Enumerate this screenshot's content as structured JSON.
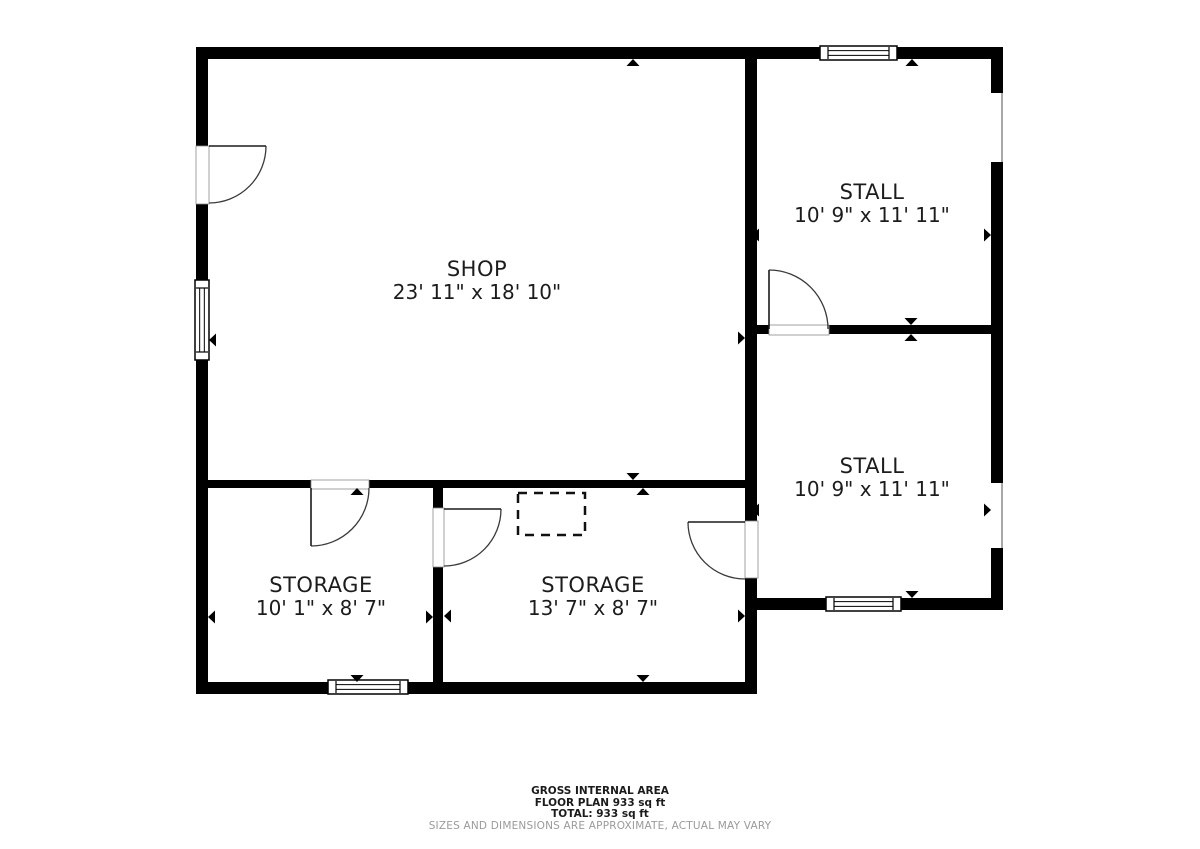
{
  "title": "Floor plan",
  "colors": {
    "wall": "#000000",
    "background": "#ffffff",
    "label_text": "#1c1c1c",
    "muted_text": "#9a9a9a",
    "door_line": "#3a3a3a",
    "opening_edge": "#8a8a8a"
  },
  "rooms": [
    {
      "id": "shop",
      "name": "SHOP",
      "dims": "23' 11\" x 18' 10\"",
      "cx": 477,
      "cy": 281
    },
    {
      "id": "stall-1",
      "name": "STALL",
      "dims": "10' 9\" x 11' 11\"",
      "cx": 872,
      "cy": 204
    },
    {
      "id": "stall-2",
      "name": "STALL",
      "dims": "10' 9\" x 11' 11\"",
      "cx": 872,
      "cy": 478
    },
    {
      "id": "storage-1",
      "name": "STORAGE",
      "dims": "10' 1\" x 8' 7\"",
      "cx": 321,
      "cy": 597
    },
    {
      "id": "storage-2",
      "name": "STORAGE",
      "dims": "13' 7\" x 8' 7\"",
      "cx": 593,
      "cy": 597
    }
  ],
  "footer": {
    "line1": "GROSS INTERNAL AREA",
    "line2": "FLOOR PLAN 933 sq ft",
    "line3": "TOTAL: 933 sq ft",
    "disclaimer": "SIZES AND DIMENSIONS ARE APPROXIMATE, ACTUAL MAY VARY"
  },
  "geometry": {
    "canvas": {
      "width": 1200,
      "height": 849
    },
    "walls": [
      {
        "name": "exterior-wall-top",
        "x": 196,
        "y": 47,
        "w": 807,
        "h": 12
      },
      {
        "name": "exterior-wall-left",
        "x": 196,
        "y": 47,
        "w": 12,
        "h": 647
      },
      {
        "name": "exterior-wall-right",
        "x": 991,
        "y": 47,
        "w": 12,
        "h": 563
      },
      {
        "name": "exterior-wall-bottom",
        "x": 196,
        "y": 682,
        "w": 561,
        "h": 12
      },
      {
        "name": "wall-center-vertical",
        "x": 745,
        "y": 47,
        "w": 12,
        "h": 647
      },
      {
        "name": "wall-shop-storage",
        "x": 208,
        "y": 480,
        "w": 537,
        "h": 8
      },
      {
        "name": "wall-stall-divider",
        "x": 757,
        "y": 325,
        "w": 234,
        "h": 9
      },
      {
        "name": "wall-stall2-bottom",
        "x": 757,
        "y": 598,
        "w": 246,
        "h": 12
      },
      {
        "name": "wall-storage-divider",
        "x": 433,
        "y": 488,
        "w": 10,
        "h": 194
      }
    ],
    "openings": [
      {
        "name": "opening-stall1-right-wall",
        "x": 991,
        "y": 93,
        "w": 12,
        "h": 69
      },
      {
        "name": "opening-stall2-right-wall",
        "x": 991,
        "y": 483,
        "w": 12,
        "h": 65
      }
    ],
    "windows": [
      {
        "name": "window-stall1-top",
        "x": 820,
        "y": 46,
        "w": 77,
        "h": 14,
        "orient": "h"
      },
      {
        "name": "window-shop-left",
        "x": 195,
        "y": 280,
        "w": 14,
        "h": 80,
        "orient": "v"
      },
      {
        "name": "window-storage1-bottom",
        "x": 328,
        "y": 680,
        "w": 80,
        "h": 14,
        "orient": "h"
      },
      {
        "name": "window-stall2-bottom",
        "x": 826,
        "y": 597,
        "w": 75,
        "h": 14,
        "orient": "h"
      }
    ],
    "doors": [
      {
        "name": "door-shop-entry",
        "opening": {
          "x": 196,
          "y": 146,
          "w": 13,
          "h": 58
        },
        "panel": [
          209,
          146,
          266,
          146
        ],
        "arc": "M 266 146 A 57 57 0 0 1 209 203"
      },
      {
        "name": "door-storage1",
        "opening": {
          "x": 311,
          "y": 480,
          "w": 58,
          "h": 9
        },
        "panel": [
          311,
          488,
          311,
          546
        ],
        "arc": "M 311 546 A 58 58 0 0 0 369 488"
      },
      {
        "name": "door-storage1-storage2",
        "opening": {
          "x": 433,
          "y": 508,
          "w": 11,
          "h": 59
        },
        "panel": [
          444,
          509,
          501,
          509
        ],
        "arc": "M 501 509 A 57 57 0 0 1 444 566"
      },
      {
        "name": "door-storage2-stall2",
        "opening": {
          "x": 745,
          "y": 521,
          "w": 13,
          "h": 57
        },
        "panel": [
          745,
          522,
          688,
          522
        ],
        "arc": "M 688 522 A 57 57 0 0 0 745 579"
      },
      {
        "name": "door-stall1-stall2",
        "opening": {
          "x": 769,
          "y": 325,
          "w": 60,
          "h": 10
        },
        "panel": [
          769,
          329,
          769,
          270
        ],
        "arc": "M 769 270 A 59 59 0 0 1 828 329"
      }
    ],
    "arrows": [
      {
        "room": "shop",
        "dir": "up",
        "x": 633,
        "y": 59
      },
      {
        "room": "shop",
        "dir": "down",
        "x": 633,
        "y": 480
      },
      {
        "room": "shop",
        "dir": "left",
        "x": 209,
        "y": 340
      },
      {
        "room": "shop",
        "dir": "right",
        "x": 745,
        "y": 338
      },
      {
        "room": "stall-1",
        "dir": "up",
        "x": 912,
        "y": 59
      },
      {
        "room": "stall-1",
        "dir": "down",
        "x": 911,
        "y": 325
      },
      {
        "room": "stall-1",
        "dir": "left",
        "x": 752,
        "y": 235
      },
      {
        "room": "stall-1",
        "dir": "right",
        "x": 991,
        "y": 235
      },
      {
        "room": "stall-2",
        "dir": "up",
        "x": 911,
        "y": 334
      },
      {
        "room": "stall-2",
        "dir": "down",
        "x": 912,
        "y": 598
      },
      {
        "room": "stall-2",
        "dir": "left",
        "x": 752,
        "y": 510
      },
      {
        "room": "stall-2",
        "dir": "right",
        "x": 991,
        "y": 510
      },
      {
        "room": "storage-1",
        "dir": "up",
        "x": 357,
        "y": 488
      },
      {
        "room": "storage-1",
        "dir": "down",
        "x": 357,
        "y": 682
      },
      {
        "room": "storage-1",
        "dir": "left",
        "x": 208,
        "y": 617
      },
      {
        "room": "storage-1",
        "dir": "right",
        "x": 433,
        "y": 617
      },
      {
        "room": "storage-2",
        "dir": "up",
        "x": 643,
        "y": 488
      },
      {
        "room": "storage-2",
        "dir": "down",
        "x": 643,
        "y": 682
      },
      {
        "room": "storage-2",
        "dir": "left",
        "x": 444,
        "y": 616
      },
      {
        "room": "storage-2",
        "dir": "right",
        "x": 745,
        "y": 616
      }
    ],
    "dashed_box": {
      "name": "dashed-fixture-box",
      "x": 518,
      "y": 493,
      "w": 67,
      "h": 42
    }
  }
}
